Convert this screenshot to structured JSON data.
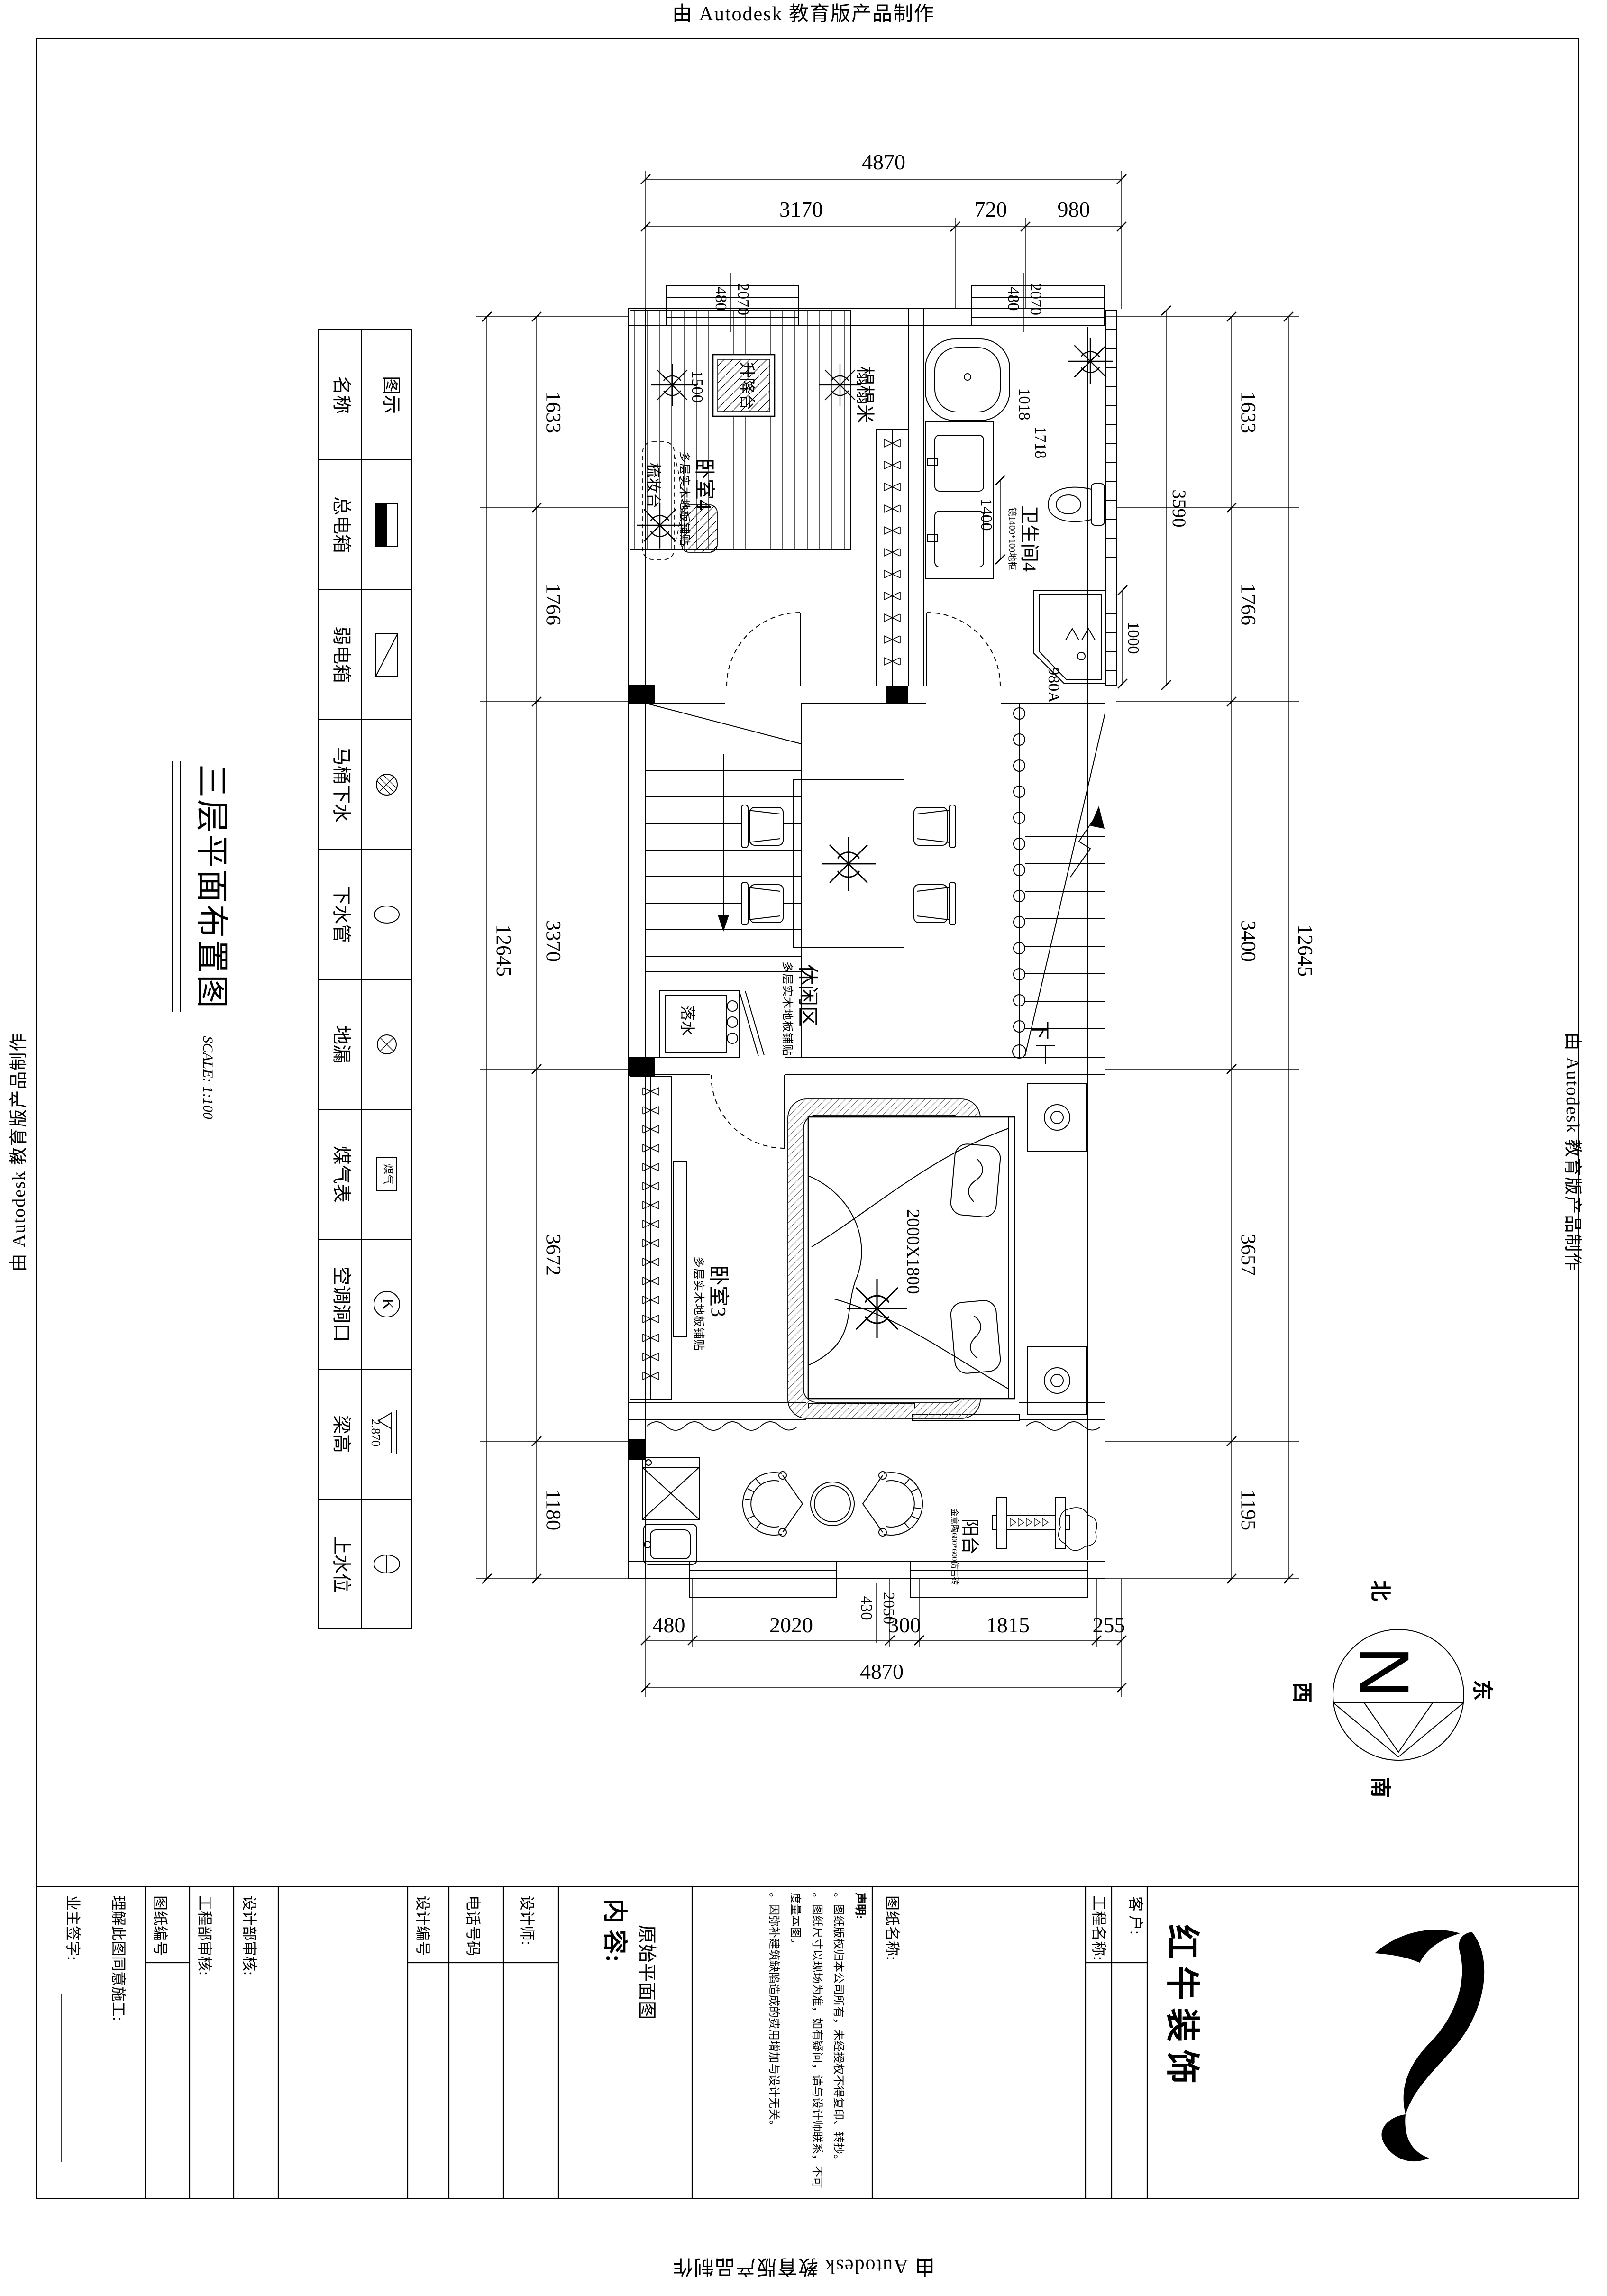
{
  "watermark": "由 Autodesk 教育版产品制作",
  "title": {
    "text": "三层平面布置图",
    "scale": "SCALE: 1:100"
  },
  "legend": {
    "col_name": "名称",
    "col_symbol": "图示",
    "rows": [
      {
        "label": "总电箱"
      },
      {
        "label": "弱电箱"
      },
      {
        "label": "马桶下水"
      },
      {
        "label": "下水管"
      },
      {
        "label": "地漏"
      },
      {
        "label": "煤气表"
      },
      {
        "label": "空调洞口"
      },
      {
        "label": "梁高"
      },
      {
        "label": "上水位"
      }
    ],
    "gas_text": "煤气",
    "ac_text": "K",
    "beam_text": "2.870"
  },
  "dims": {
    "top_overall": "4870",
    "top_seg": [
      "3170",
      "720",
      "980"
    ],
    "bottom_seg": [
      "480",
      "2020",
      "300",
      "1815",
      "255"
    ],
    "bottom_overall": "4870",
    "left_seg": [
      "1633",
      "1766",
      "3370",
      "3672",
      "1180"
    ],
    "left_overall": "12645",
    "right_seg": [
      "1633",
      "1766",
      "3400",
      "3657",
      "1195"
    ],
    "right_overall": "12645",
    "win_top_w": "2070",
    "win_top_h": "480",
    "win_bottom_w": "2050",
    "win_bottom_h": "430",
    "lift": "1500",
    "tub_dia": "1018",
    "tub_len": "1718",
    "vanity": "1400",
    "bath": "3590",
    "shower": "1000",
    "shower_w": "980A"
  },
  "rooms": {
    "bedroom4": "卧室4",
    "tatami": "榻榻米",
    "lift": "升降台",
    "dresser": "梳妆台",
    "floor_note": "多层实木地板铺贴",
    "bath4": "卫生间4",
    "bath_note": "镜1400*100地柜",
    "leisure": "休闲区",
    "down": "下",
    "drain": "落水",
    "bedroom3": "卧室3",
    "bed": "2000X1800",
    "balcony": "阳台",
    "balcony_note": "金意陶600*600仿古砖"
  },
  "compass": {
    "n": "N",
    "north": "北",
    "south": "南",
    "west": "西",
    "east": "东"
  },
  "tb": {
    "owner": "业主签字:",
    "agree": "理解此图同意施工:",
    "sheet_no": "图纸编号",
    "eng": "工程部审核:",
    "design_dept": "设计部审核:",
    "design_no": "设计编号",
    "phone": "电话号码",
    "designer": "设计师:",
    "content_label": "内 容:",
    "content": "原始平面图",
    "stmt_title": "声明:",
    "stmt": [
      "。图纸版权归本公司所有，未经授权不得复印、转抄。",
      "。图纸尺寸以现场为准，如有疑问，请与设计师联系，不可度量本图。",
      "。因弥补建筑缺陷造成的费用增加与设计无关。"
    ],
    "sheet_name": "图纸名称:",
    "project": "工程名称:",
    "client": "客 户:",
    "company": "红牛装饰"
  }
}
